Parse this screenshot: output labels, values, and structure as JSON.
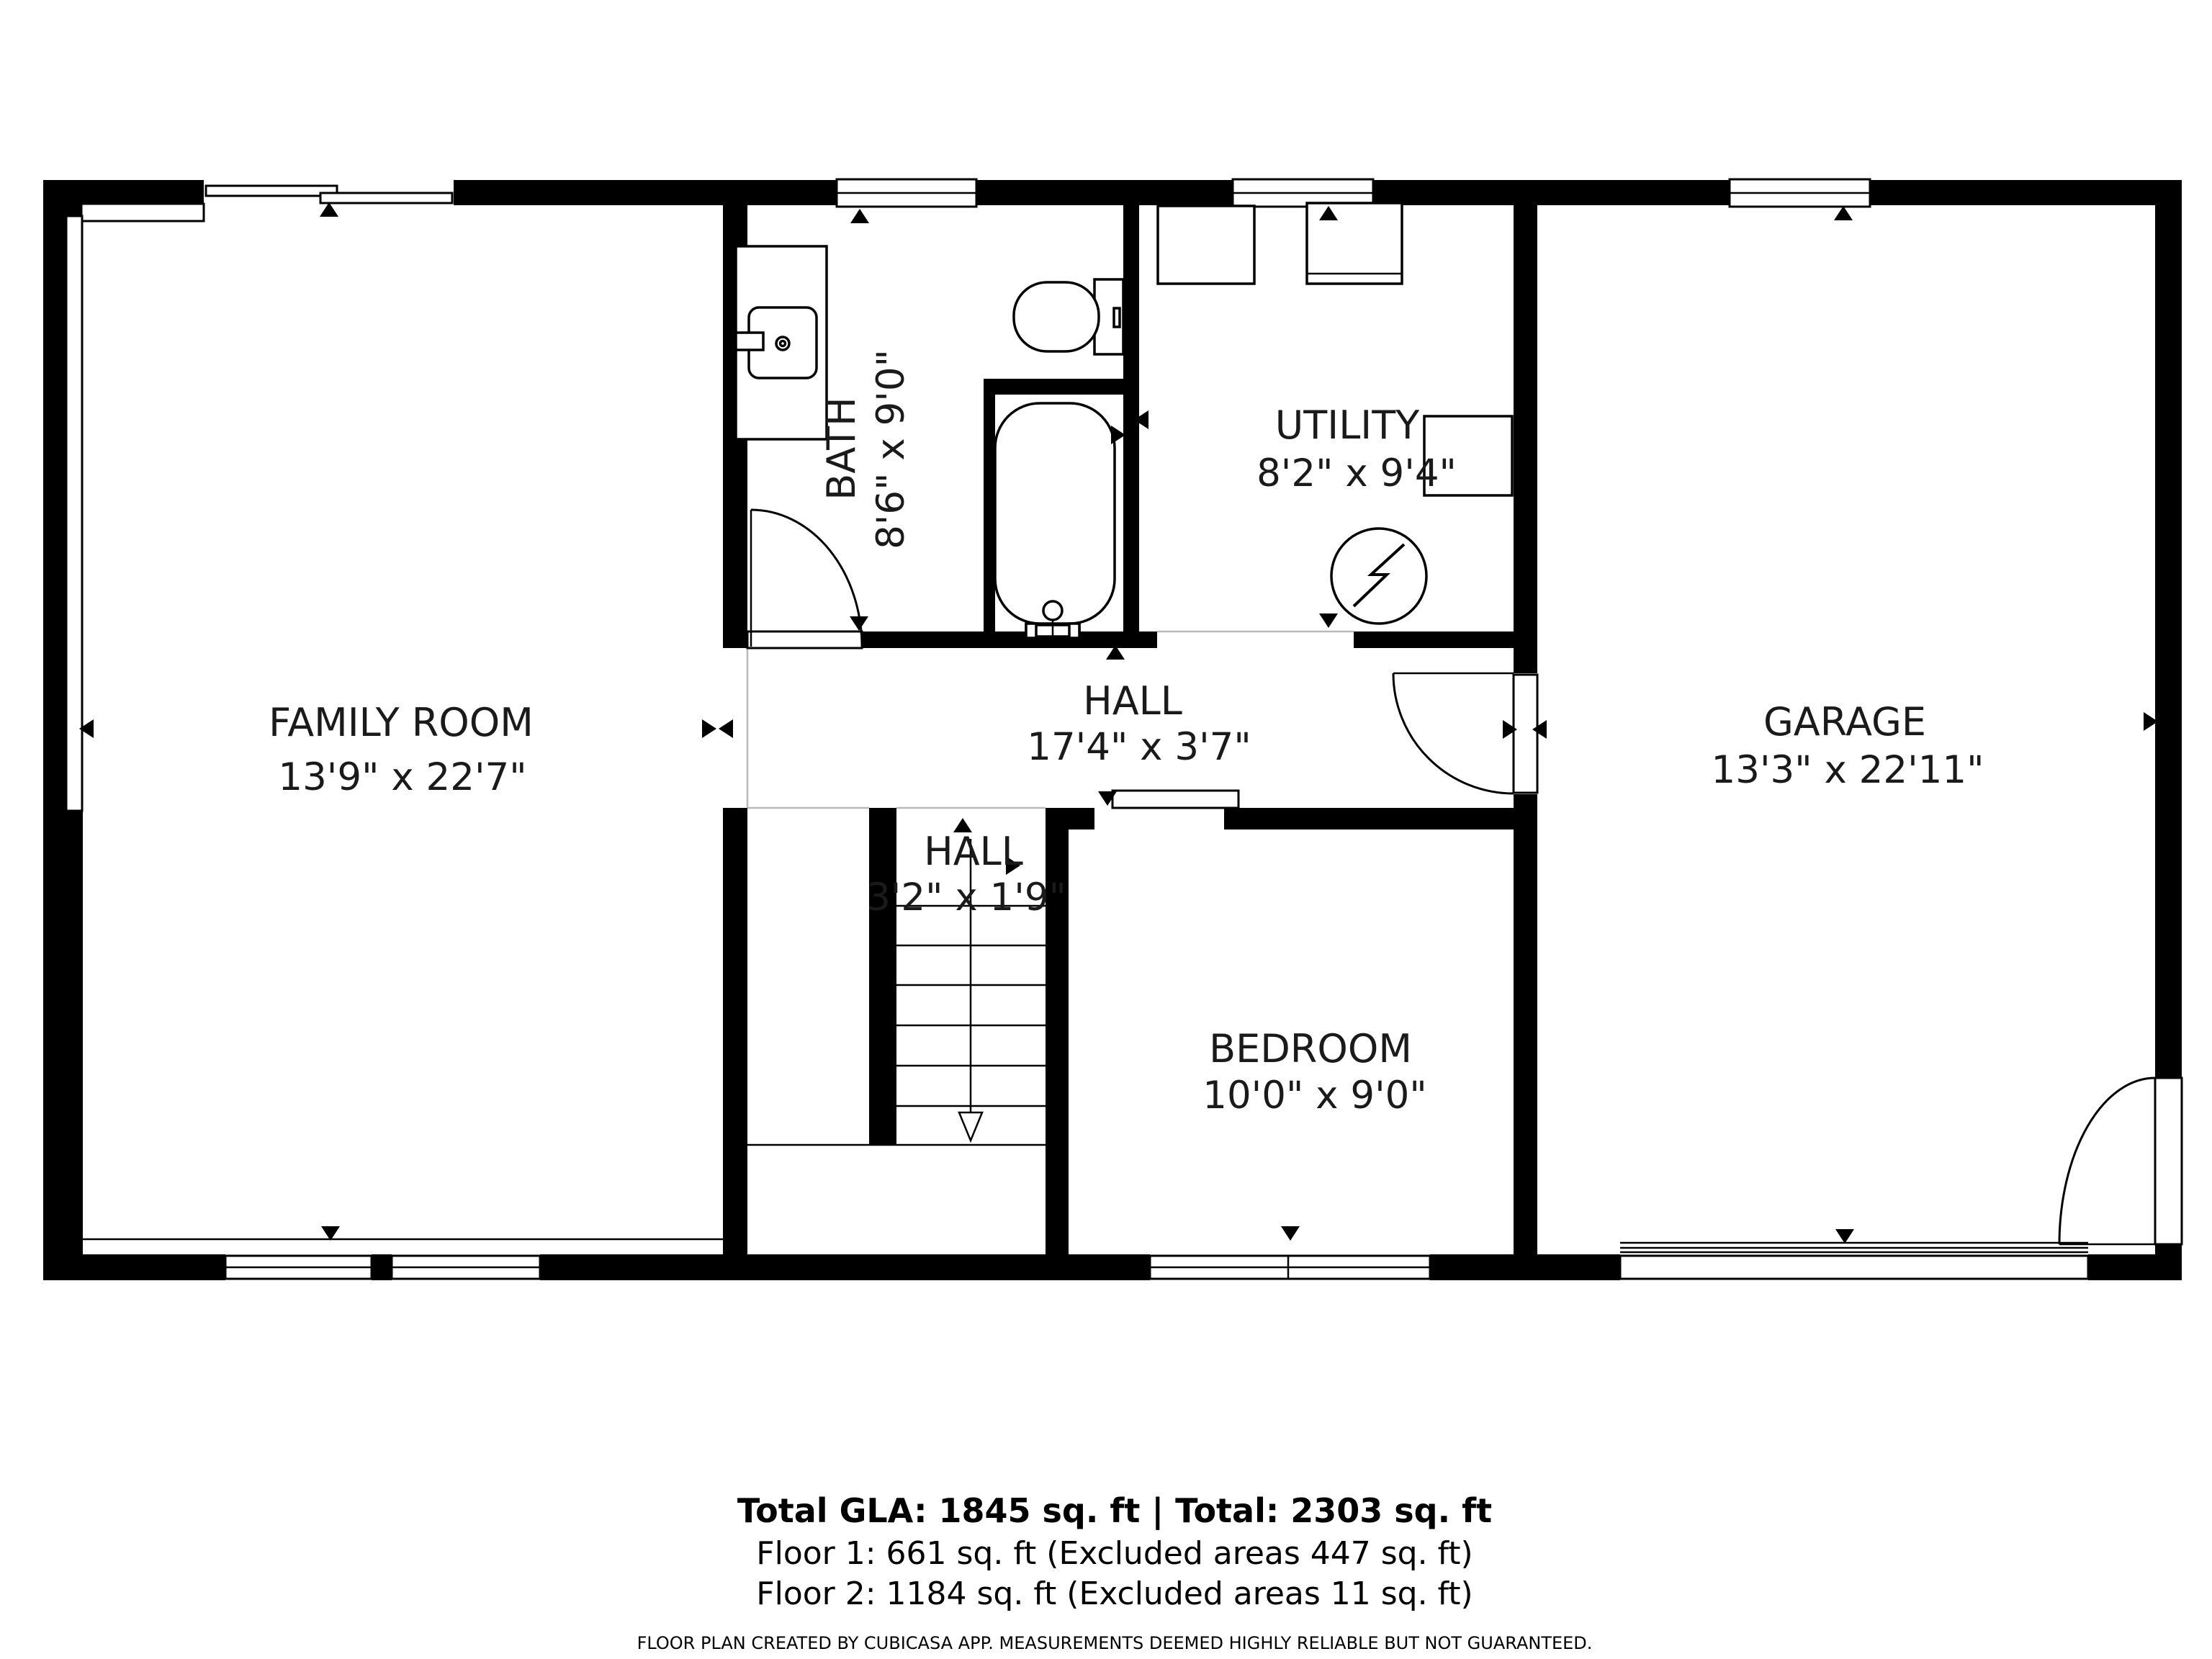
{
  "plan": {
    "rooms": [
      {
        "name": "FAMILY ROOM",
        "dims": "13'9\" x 22'7\""
      },
      {
        "name": "BATH",
        "dims": "8'6\" x 9'0\""
      },
      {
        "name": "UTILITY",
        "dims": "8'2\" x 9'4\""
      },
      {
        "name": "HALL",
        "dims": "17'4\" x 3'7\""
      },
      {
        "name": "HALL",
        "dims": "3'2\" x 1'9\""
      },
      {
        "name": "BEDROOM",
        "dims": "10'0\" x 9'0\""
      },
      {
        "name": "GARAGE",
        "dims": "13'3\" x 22'11\""
      }
    ]
  },
  "footer": {
    "totals": "Total GLA: 1845 sq. ft | Total: 2303 sq. ft",
    "floor1": "Floor 1: 661 sq. ft (Excluded areas 447 sq. ft)",
    "floor2": "Floor 2: 1184 sq. ft (Excluded areas 11 sq. ft)",
    "disclaimer": "FLOOR PLAN CREATED BY CUBICASA APP. MEASUREMENTS DEEMED HIGHLY RELIABLE BUT NOT GUARANTEED."
  },
  "colors": {
    "wall": "#000000",
    "background": "#ffffff",
    "boundary": "#b9b9b9"
  }
}
